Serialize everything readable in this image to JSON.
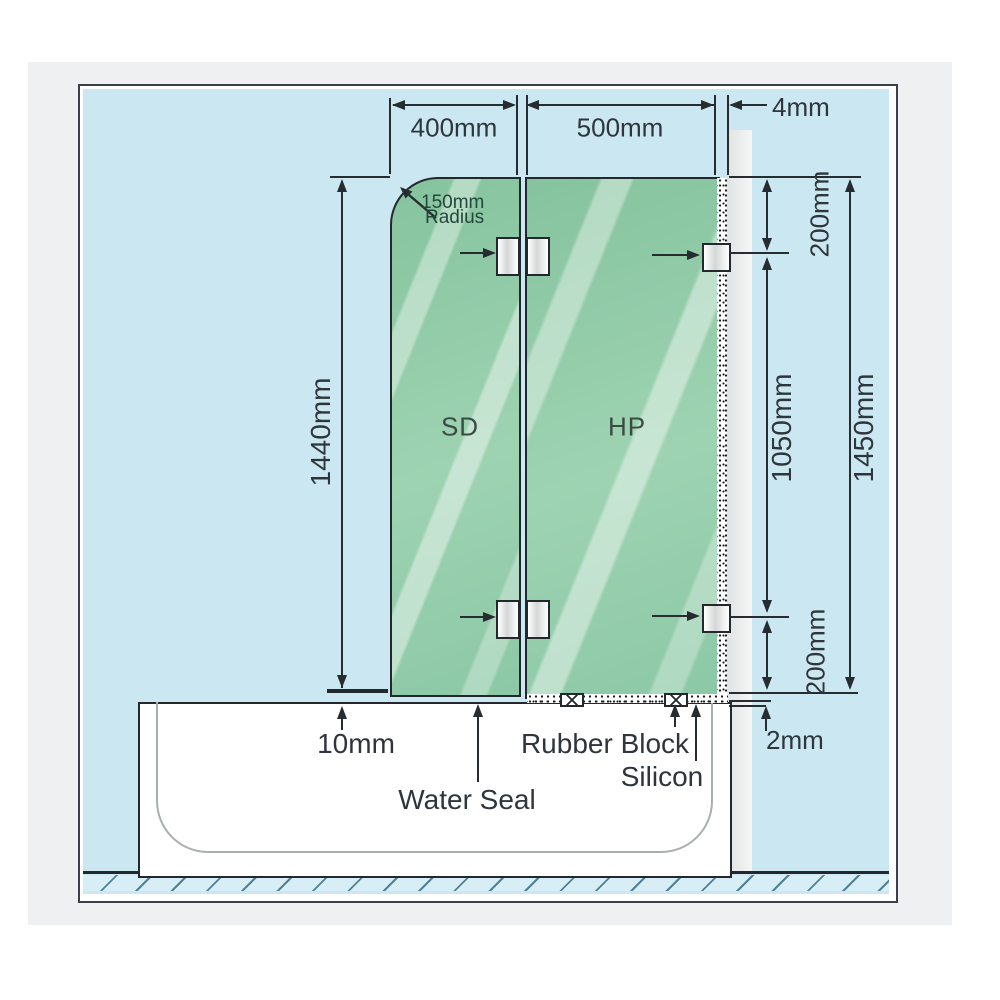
{
  "title": "Shower screen over bath installation diagram",
  "dimensions": {
    "sd_width": "400mm",
    "hp_width": "500mm",
    "wall_gap": "4mm",
    "sd_height": "1440mm",
    "top_bracket_offset": "200mm",
    "bracket_spacing": "1050mm",
    "hp_height": "1450mm",
    "bottom_bracket_offset": "200mm",
    "tub_clearance": "2mm",
    "bottom_gap": "10mm"
  },
  "labels": {
    "radius_line1": "150mm",
    "radius_line2": "Radius",
    "panel_sd": "SD",
    "panel_hp": "HP",
    "water_seal": "Water Seal",
    "rubber_block": "Rubber Block",
    "silicon": "Silicon"
  },
  "colors": {
    "background_blue": "#cbe8f2",
    "glass_green": "#93cca9",
    "wall_grey": "#e8eaea",
    "line_dark": "#272c31",
    "outer_grey": "#eef0f2"
  }
}
